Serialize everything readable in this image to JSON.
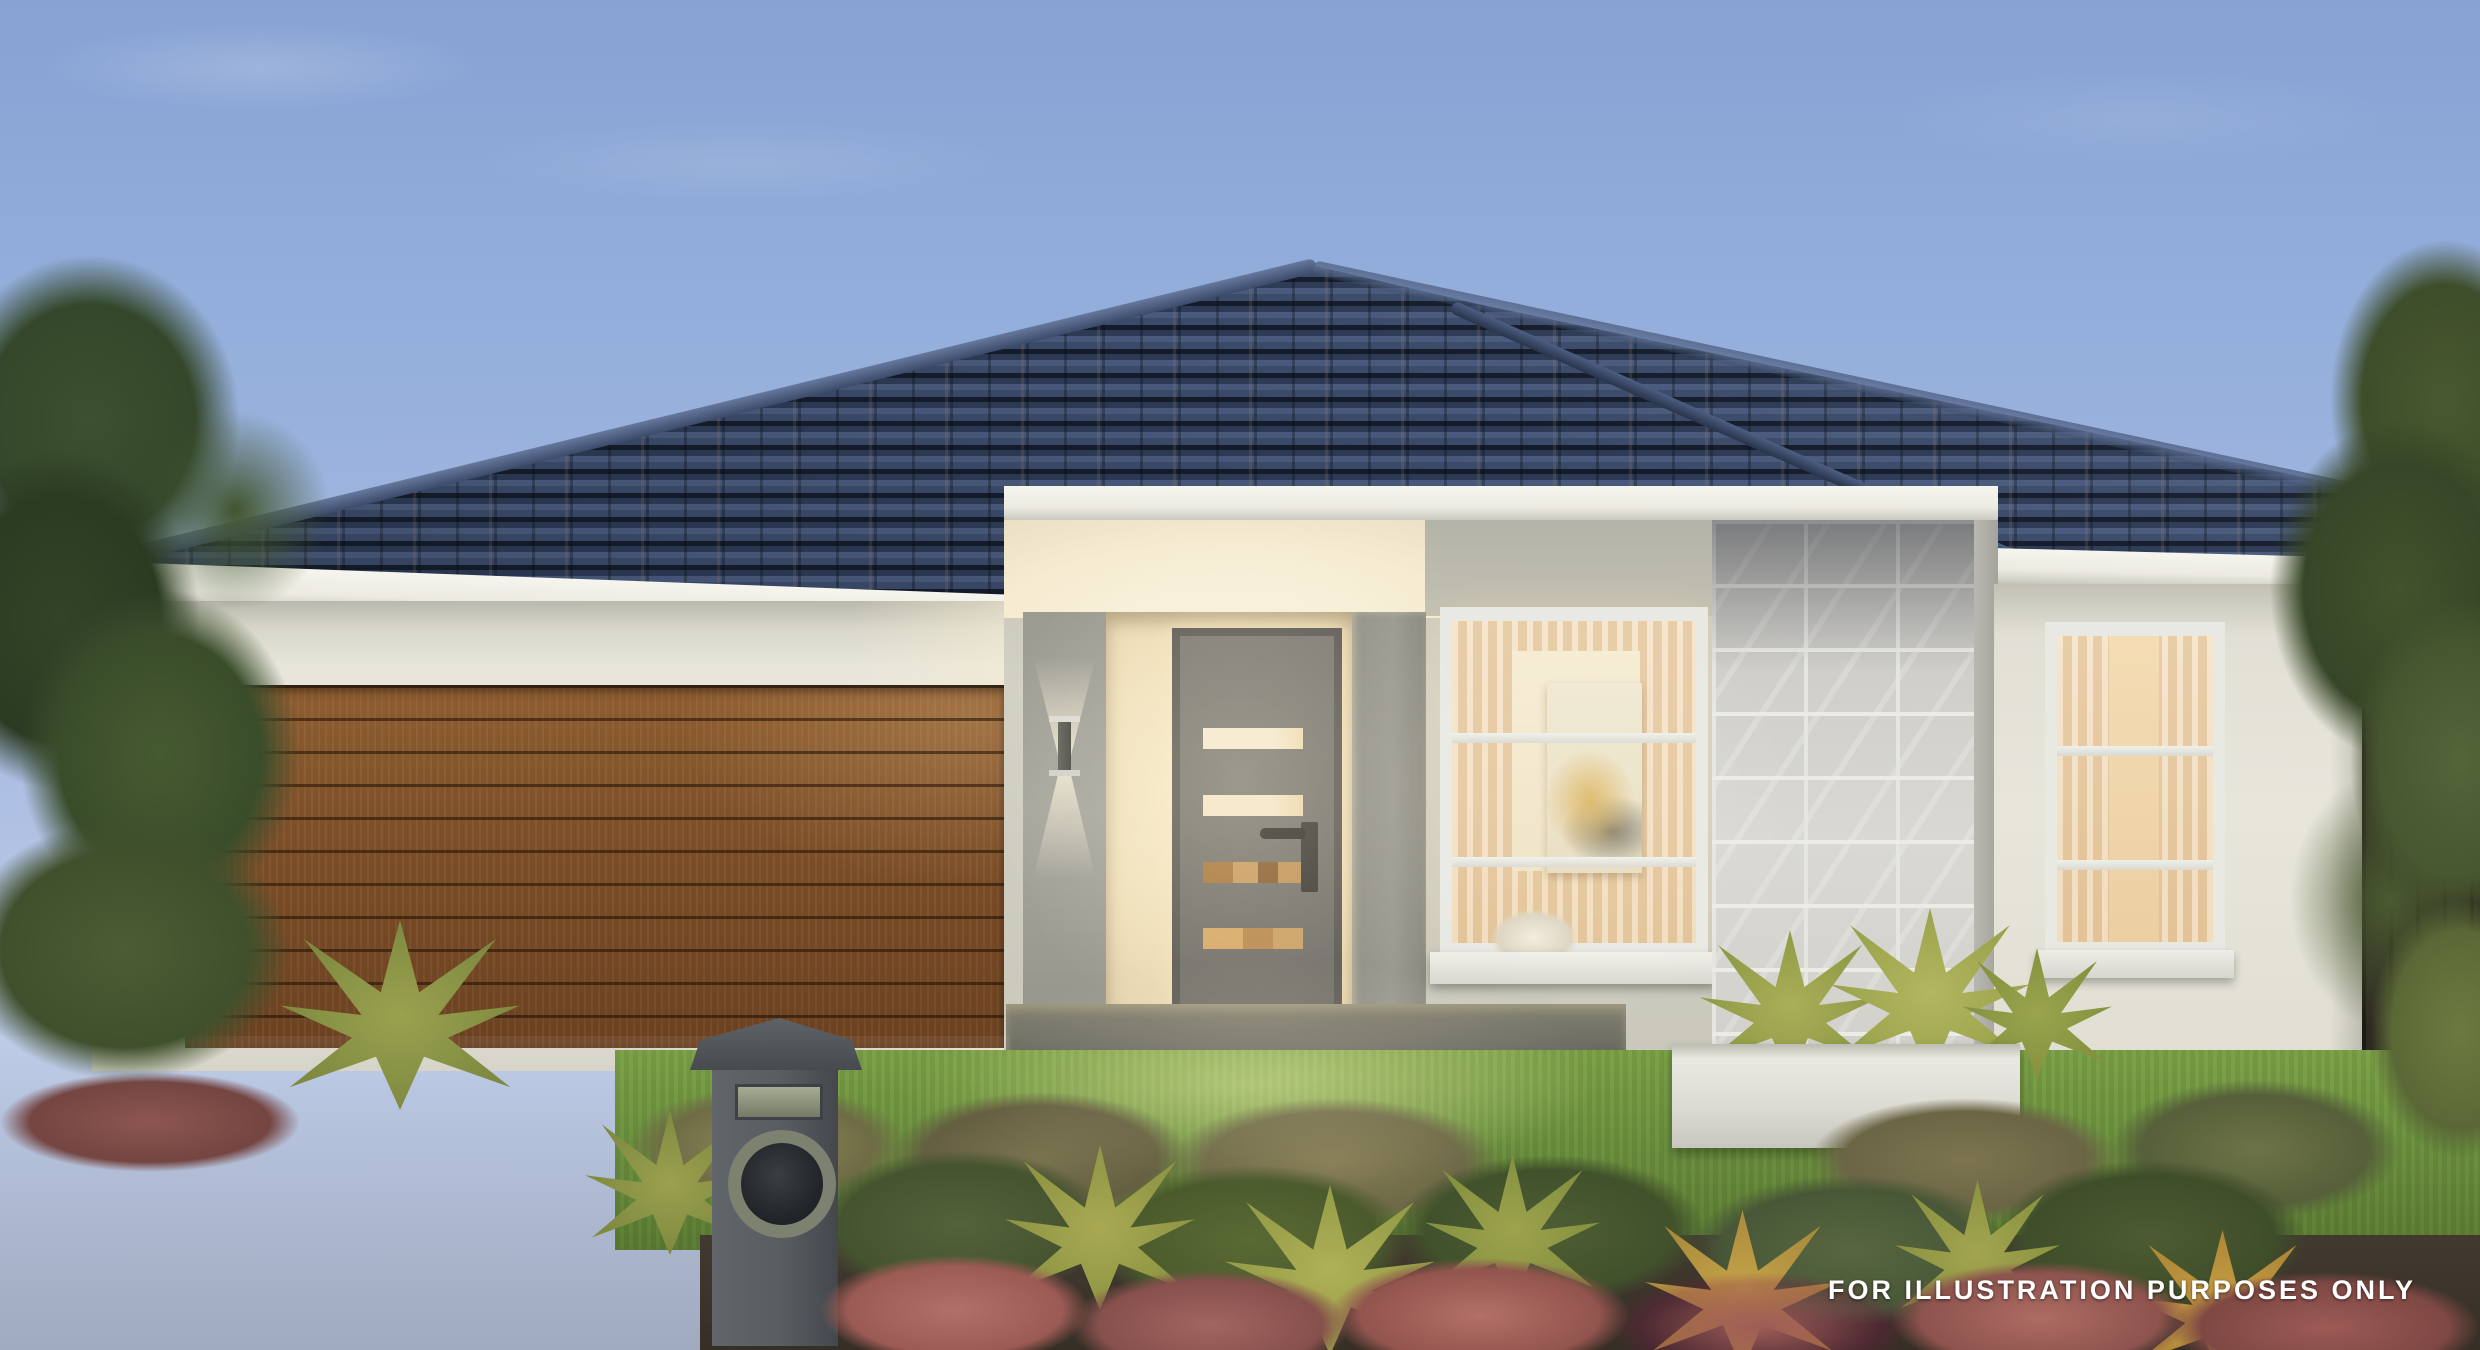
{
  "scene": {
    "description": "dusk exterior render of single-storey house with dark tiled hip roof, timber garage door, lit entry porch, stone feature pier and landscaped garden",
    "disclaimer": "FOR ILLUSTRATION PURPOSES ONLY"
  },
  "colors": {
    "sky_top": "#87A2D3",
    "sky_horizon": "#C3CFE9",
    "roof_tile": "#35425E",
    "roof_shadow": "#151D2C",
    "ridge_capping": "#5A6C91",
    "fascia_gutter": "#EFEEE7",
    "wall_render_cream": "#E8E6DB",
    "wall_render_grey": "#A3A299",
    "entry_warm_light": "#F6ECD2",
    "garage_door_timber": "#8E5D30",
    "front_door_grey": "#76746E",
    "window_frame_white": "#E9E9E3",
    "window_glow": "#F3DCB7",
    "stone_tile_grey": "#D3D2CD",
    "grass_green": "#7DA348",
    "driveway_concrete": "#6B6B62",
    "garden_red_foliage": "#9C5A55",
    "mulch_brown": "#362F26",
    "fence_timber_dark": "#2A251E",
    "tree_dark_green": "#34472A",
    "tree_olive": "#5F6E3A",
    "mailbox_grey": "#5A5F63",
    "disclaimer_text": "#FFFFFF"
  }
}
